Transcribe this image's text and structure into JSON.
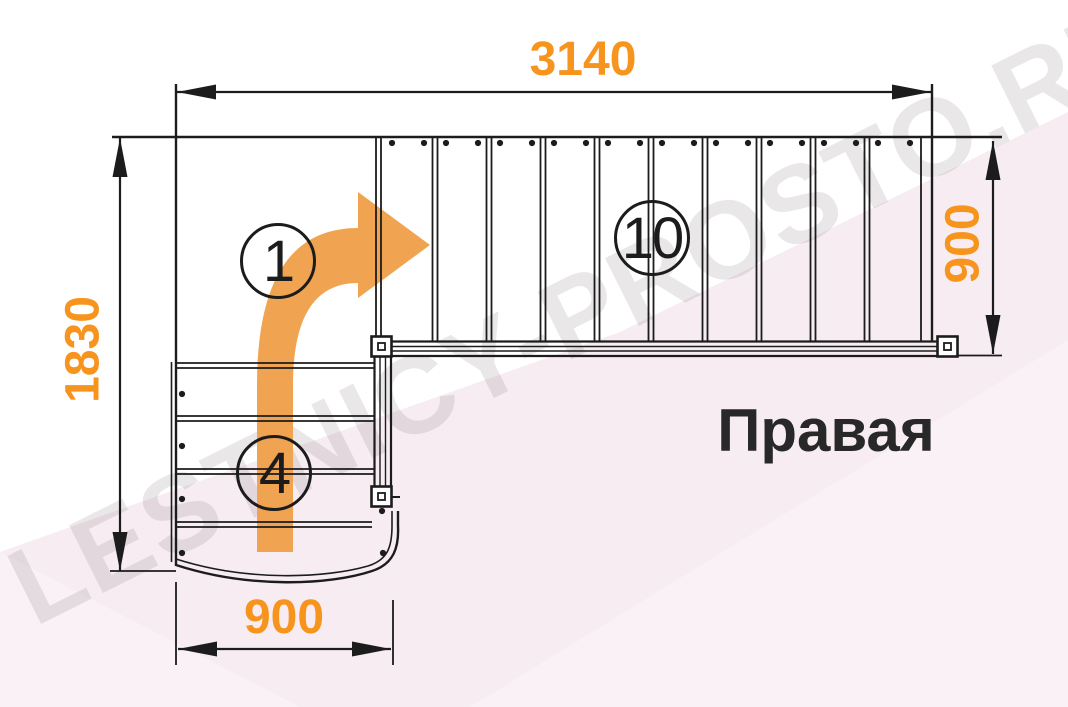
{
  "drawing": {
    "label": "Правая",
    "watermark": "LESTNICY-PROSTO.RU",
    "dimensions": {
      "top_width": "3140",
      "left_height": "1830",
      "right_height": "900",
      "bottom_width": "900"
    },
    "steps": {
      "corner_step_number": "1",
      "lower_flight_count": "4",
      "upper_flight_count": "10"
    }
  },
  "colors": {
    "dimension_orange": "#f7941e",
    "arrow_orange": "#f0a452",
    "line_black": "#1c1c1c",
    "label_black": "#282828",
    "bg_pink": "#f6ecf2",
    "bg_pink_light": "#faf1f6",
    "watermark_gray": "rgba(120,104,114,0.16)"
  }
}
